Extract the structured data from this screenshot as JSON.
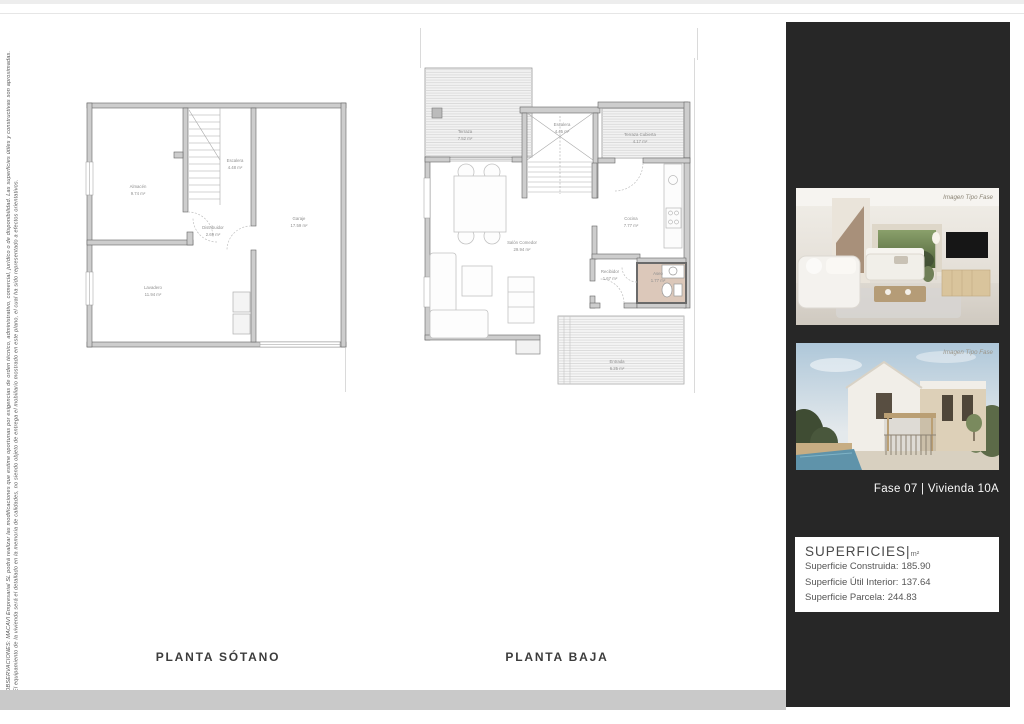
{
  "disclaimer": {
    "line1": "OBSERVACIONES: MACAVI Empresarial SL podrá realizar las modificaciones que estime oportunas por exigencias de orden técnico, administrativo, comercial, jurídico o de disponibilidad. Las superficies útiles y constructivas son aproximadas.",
    "line2": "El equipamiento de la vivienda será el detallado en la memoria de calidades, no siendo objeto de entrega el mobiliario mostrado en este plano, el cual ha sido representado a efectos orientativos."
  },
  "plans": {
    "sotano": {
      "title": "PLANTA SÓTANO",
      "rooms": [
        {
          "name": "Almacén",
          "area": "9.74 m²"
        },
        {
          "name": "Escalera",
          "area": "4.48 m²"
        },
        {
          "name": "Distribuidor",
          "area": "2.69 m²"
        },
        {
          "name": "Garaje",
          "area": "17.59 m²"
        },
        {
          "name": "Lavadero",
          "area": "11.94 m²"
        }
      ]
    },
    "baja": {
      "title": "PLANTA BAJA",
      "rooms": [
        {
          "name": "Terraza",
          "area": "7.52 m²"
        },
        {
          "name": "Escalera",
          "area": "4.45 m²"
        },
        {
          "name": "Terraza Cubierta",
          "area": "4.17 m²"
        },
        {
          "name": "Cocina",
          "area": "7.77 m²"
        },
        {
          "name": "Salón Comedor",
          "area": "29.94 m²"
        },
        {
          "name": "Recibidor",
          "area": "1.67 m²"
        },
        {
          "name": "Aseo",
          "area": "1.77 m²"
        },
        {
          "name": "Entrada",
          "area": "6.25 m²"
        }
      ]
    }
  },
  "sidebar": {
    "fase_label": "Fase 07 |  Vivienda 10A",
    "images": [
      {
        "caption": "Imagen Tipo Fase"
      },
      {
        "caption": "Imagen Tipo Fase"
      }
    ],
    "superficies": {
      "title": "SUPERFICIES",
      "sep": "|",
      "unit": "m²",
      "rows": [
        {
          "label": "Superficie Construida:",
          "value": "185.90"
        },
        {
          "label": "Superficie Útil Interior:",
          "value": "137.64"
        },
        {
          "label": "Superficie Parcela:",
          "value": "244.83"
        }
      ]
    }
  },
  "colors": {
    "panel_dark": "#272727",
    "footer_gray": "#c9c9c9",
    "wall_gray": "#cdcdcd",
    "aseo_fill": "#dcc8ba",
    "label_gray": "#8f8f8f"
  }
}
